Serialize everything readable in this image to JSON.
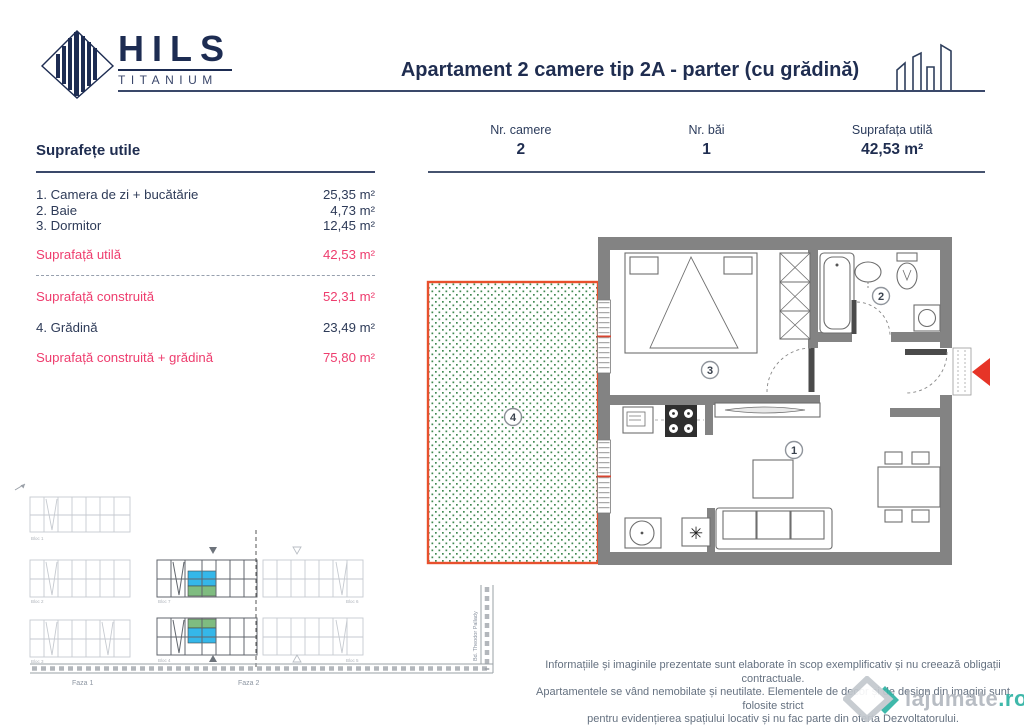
{
  "brand": {
    "name": "HILS",
    "sub": "TITANIUM"
  },
  "header": {
    "title": "Apartament 2 camere tip 2A - parter (cu grădină)"
  },
  "stats": {
    "items": [
      {
        "label": "Nr. camere",
        "value": "2"
      },
      {
        "label": "Nr. băi",
        "value": "1"
      },
      {
        "label": "Suprafața utilă",
        "value": "42,53 m²"
      }
    ]
  },
  "areas": {
    "heading": "Suprafețe utile",
    "rows": [
      {
        "label": "1. Camera de zi + bucătărie",
        "value": "25,35 m²"
      },
      {
        "label": "2. Baie",
        "value": "4,73 m²"
      },
      {
        "label": "3. Dormitor",
        "value": "12,45 m²"
      }
    ],
    "useful": {
      "label": "Suprafață utilă",
      "value": "42,53 m²"
    },
    "built": {
      "label": "Suprafață construită",
      "value": "52,31 m²"
    },
    "garden": {
      "label": "4. Grădină",
      "value": "23,49 m²"
    },
    "built_garden": {
      "label": "Suprafață construită + grădină",
      "value": "75,80 m²"
    }
  },
  "floorplan": {
    "rooms": {
      "living": "1",
      "bathroom": "2",
      "bedroom": "3",
      "garden": "4"
    },
    "dishwasher_symbol": "✳"
  },
  "siteplan": {
    "phases": [
      "Faza 1",
      "Faza 2"
    ],
    "street": "Bd. Theodor Pallady",
    "blocks": {
      "b1": "Bloc 1",
      "b2": "Bloc 2",
      "b3": "Bloc 3",
      "b7": "Bloc 7",
      "b4": "Bloc 4",
      "b6": "Bloc 6",
      "b5": "Bloc 5"
    }
  },
  "disclaimer": {
    "line1": "Informațiile și imaginile prezentate sunt elaborate în scop exemplificativ și nu creează obligații contractuale.",
    "line2": "Apartamentele se vând nemobilate și neutilate. Elementele de decor și de design din imagini sunt folosite strict",
    "line3": "pentru evidențierea spațiului locativ și nu fac parte din oferta Dezvoltatorului."
  },
  "watermark": {
    "brand": "lajumate",
    "tld": ".ro"
  },
  "colors": {
    "navy": "#1f2d50",
    "pink": "#ee3d6e",
    "wall_gray": "#838383",
    "garden_border": "#e8502d",
    "garden_dot": "#418952",
    "arrow_red": "#e63427",
    "highlight_blue": "#35b7e9",
    "highlight_green": "#7fbc80",
    "watermark_teal": "#2fb3a3"
  }
}
